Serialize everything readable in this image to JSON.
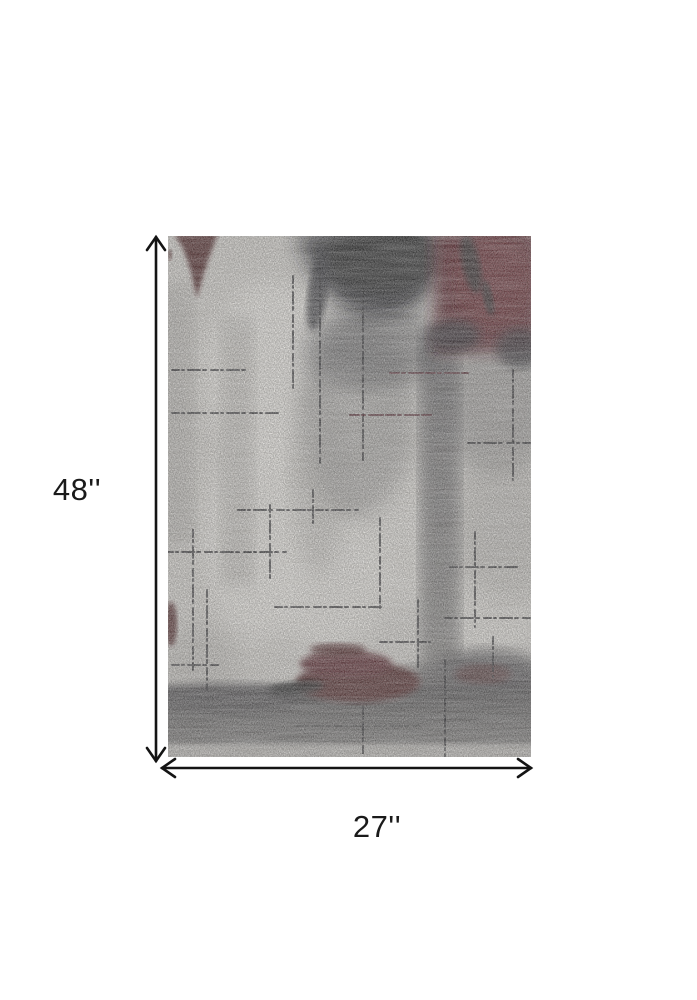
{
  "page": {
    "background_color": "#ffffff"
  },
  "annotation": {
    "height_label": "48''",
    "width_label": "27''",
    "arrow_color": "#141414",
    "label_color": "#1a1a1a"
  },
  "rug": {
    "colors": {
      "base": "#d2cfc9",
      "ivory": "#ebe8e2",
      "soft_gray": "#aeaba6",
      "mid_gray": "#8b8987",
      "streak_top": "#5a585a",
      "streak_bottom": "#7f7d7a",
      "charcoal": "#1f1e21",
      "charcoal_core": "#141317",
      "maroon": "#4d161c",
      "maroon_dark": "#431218",
      "maroon_bright": "#5d1b22",
      "band_top": "#454344",
      "band_mid": "#5e5c5b",
      "band_bottom": "#7a7876",
      "bottom_strip": "#b8b5b0",
      "scratch": "#1a191c",
      "scratch_red": "#43121a"
    }
  }
}
